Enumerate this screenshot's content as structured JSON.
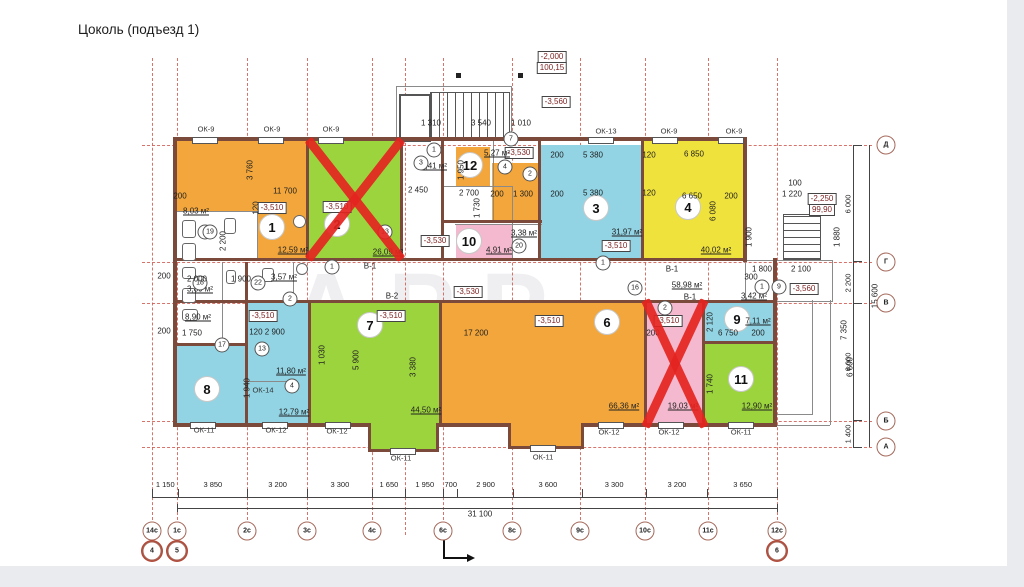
{
  "title": "Цоколь (подъезд 1)",
  "watermark": "АРР",
  "rooms": [
    {
      "number": "1",
      "level": "-3,510",
      "area": "12,59 м²"
    },
    {
      "number": "2",
      "level": "-3,510",
      "area": "26,09 м²"
    },
    {
      "number": "3",
      "level": "-3,510",
      "area": "31,97 м²"
    },
    {
      "number": "4",
      "area": "40,02 м²"
    },
    {
      "level": "-3,510",
      "area": "19,03 м²"
    },
    {
      "number": "6",
      "level": "-3,510",
      "area": "66,36 м²"
    },
    {
      "number": "7",
      "level": "-3,510",
      "area": "44,50 м²"
    },
    {
      "number": "8"
    },
    {
      "number": "9",
      "area": "7,11 м²"
    },
    {
      "number": "10",
      "area": "4,91 м²"
    },
    {
      "number": "11",
      "area": "12,90 м²"
    },
    {
      "number": "12",
      "area": "5,27 м²"
    },
    {
      "marker": "13",
      "level": "-3,510",
      "area_upper": "11,80 м²",
      "area_lower": "12,79 м²"
    }
  ],
  "sanitary": {
    "area_803": "8,03 м²",
    "area_357": "3,57 м²",
    "area_380": "3,80 м²",
    "area_890": "8,90 м²"
  },
  "halls": {
    "level_a": "-3,530",
    "level_b": "-3,530",
    "area_441": "4,41 м²",
    "area_338": "3,38 м²",
    "area_342": "3,42 м²"
  },
  "corridor": {
    "area": "58,98 м²",
    "b1a": "В-1",
    "b2": "В-2",
    "b1b": "В-1",
    "b1c": "В-1",
    "level": "-3,530"
  },
  "elevations": {
    "e2000": "-2,000",
    "e10015": "100,15",
    "e3560a": "-3,560",
    "e2250": "-2,250",
    "e9990": "99,90",
    "e3560b": "-3,560"
  },
  "axes_bottom": [
    "14с",
    "1с",
    "2с",
    "3с",
    "4с",
    "6с",
    "8с",
    "9с",
    "10с",
    "11с",
    "12с"
  ],
  "axes_bottom2": [
    "4",
    "5",
    "6"
  ],
  "axes_right": [
    "Д",
    "Г",
    "В",
    "Б",
    "А"
  ],
  "dims_bottom": [
    "1 150",
    "3 850",
    "3 200",
    "3 300",
    "1 650",
    "1 950",
    "700",
    "2 900",
    "3 600",
    "3 300",
    "3 200",
    "3 650"
  ],
  "dim_total_bottom": "31 100",
  "dims_right": [
    "6 000",
    "2 200",
    "6 000",
    "1 400"
  ],
  "dim_total_right": "15 600",
  "dims_misc": [
    "200",
    "11 700",
    "3 760",
    "120",
    "2 450",
    "2 700",
    "200",
    "1 300",
    "200",
    "5 380",
    "120",
    "6 850",
    "6 650",
    "200",
    "6 080",
    "1 310",
    "3 540",
    "1 010",
    "100",
    "1 220",
    "2 100",
    "1 800",
    "1 880",
    "17 200",
    "2 000",
    "1 900",
    "120  2 900",
    "1 750",
    "6 750",
    "200",
    "7 350",
    "6 600",
    "2 200",
    "200",
    "200",
    "1 940",
    "3 380",
    "5 900",
    "1 030",
    "200",
    "2 120",
    "1 740",
    "300",
    "1 900",
    "1 730",
    "1 950",
    "5 380",
    "120",
    "200"
  ],
  "windows_top": [
    "ОК-9",
    "ОК-9",
    "ОК-9",
    "ОК-13",
    "ОК-9",
    "ОК-9"
  ],
  "windows_bottom": [
    "ОК-11",
    "ОК-12",
    "ОК-12",
    "ОК-11",
    "ОК-11",
    "ОК-12",
    "ОК-12",
    "ОК-11"
  ],
  "window_14": "ОК-14",
  "door_markers": [
    "1",
    "1",
    "1",
    "2",
    "2",
    "3",
    "4",
    "4",
    "5",
    "7",
    "1",
    "9",
    "16",
    "17",
    "18",
    "19",
    "20",
    "22",
    "2",
    "13"
  ]
}
